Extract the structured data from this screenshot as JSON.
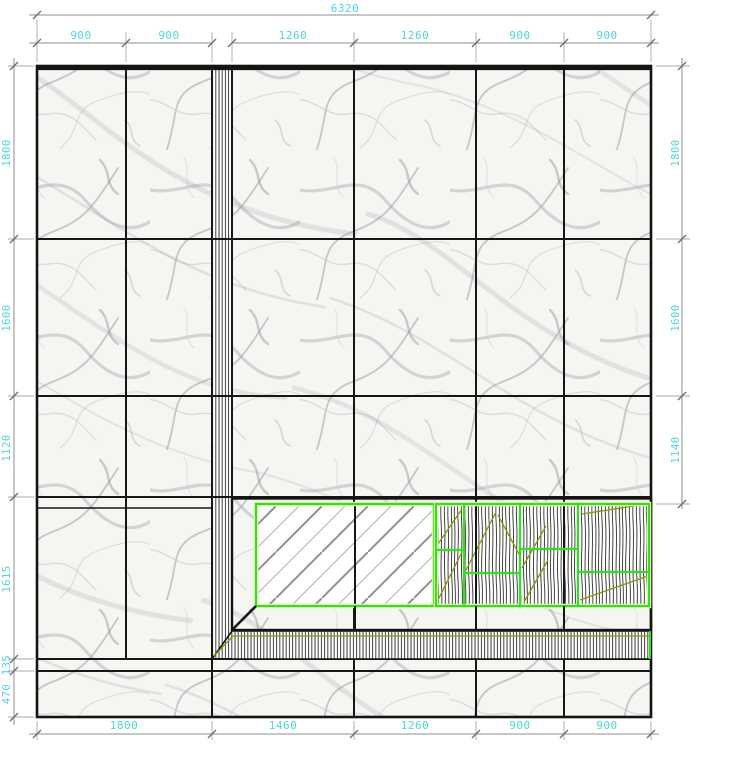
{
  "drawing": {
    "type": "wall-elevation",
    "materials": [
      "marble-tiles",
      "mirror-diagonal-hatch",
      "wood-grain-veneer",
      "groove-hatch-trim"
    ],
    "colors": {
      "dimension_text": "#4fd6d6",
      "dimension_line": "#8f8f8f",
      "tile_joint": "#161616",
      "panel_outline_green": "#2ce41b",
      "panel_glow": "#eef8b4",
      "veneer_accent_olive": "#8f9300",
      "marble_base": "#f5f5f2",
      "marble_vein": "#a0a7ae"
    }
  },
  "dimensions": {
    "top": {
      "overall": "6320",
      "segments": [
        "900",
        "900",
        "1260",
        "1260",
        "900",
        "900"
      ]
    },
    "bottom": {
      "segments": [
        "1800",
        "1460",
        "1260",
        "900",
        "900"
      ]
    },
    "left": {
      "segments": [
        "1800",
        "1600",
        "1120",
        "1615",
        "135",
        "470"
      ]
    },
    "right": {
      "segments": [
        "1800",
        "1600",
        "1140"
      ]
    }
  }
}
